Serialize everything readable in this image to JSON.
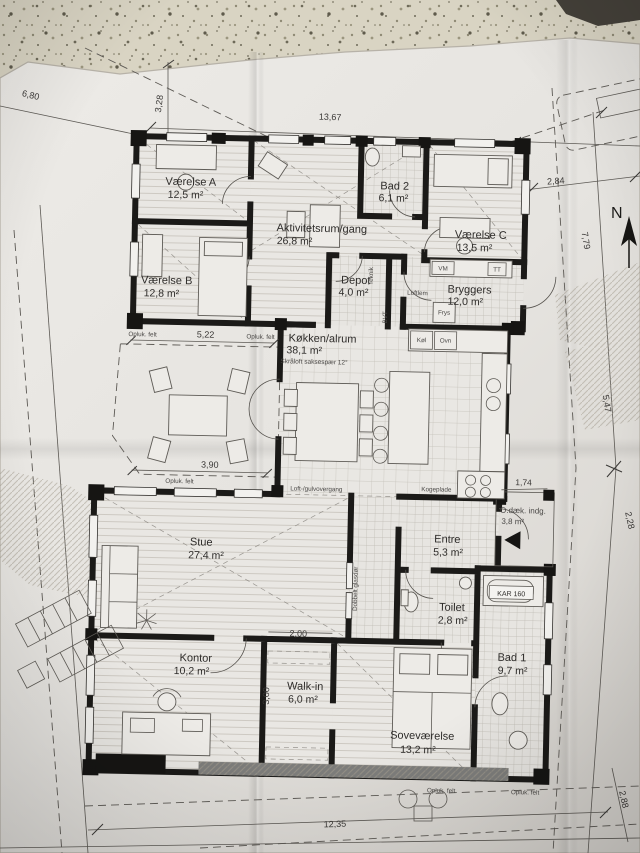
{
  "compass": {
    "north_label": "N"
  },
  "rooms": [
    {
      "name": "Værelse A",
      "area": "12,5 m²"
    },
    {
      "name": "Værelse B",
      "area": "12,8 m²"
    },
    {
      "name": "Aktivitetsrum/gang",
      "area": "26,8 m²"
    },
    {
      "name": "Bad 2",
      "area": "6,1 m²"
    },
    {
      "name": "Værelse C",
      "area": "13,5 m²"
    },
    {
      "name": "Depot",
      "area": "4,0 m²"
    },
    {
      "name": "Bryggers",
      "area": "12,0 m²"
    },
    {
      "name": "Køkken/alrum",
      "area": "38,1 m²",
      "note": "Skråloft saksespær 12°"
    },
    {
      "name": "Stue",
      "area": "27,4 m²"
    },
    {
      "name": "Entre",
      "area": "5,3 m²"
    },
    {
      "name": "Toilet",
      "area": "2,8 m²"
    },
    {
      "name": "Kontor",
      "area": "10,2 m²"
    },
    {
      "name": "Walk-in",
      "area": "6,0 m²"
    },
    {
      "name": "Soveværelse",
      "area": "13,2 m²"
    },
    {
      "name": "Bad 1",
      "area": "9,7 m²"
    },
    {
      "name": "O.dæk. indg.",
      "area": "3,8 m²"
    }
  ],
  "dimensions": {
    "top_left_diagonal": "6,80",
    "top_vertical": "3,28",
    "top_width": "13,67",
    "right_upper": "2,84",
    "right_boundary_upper": "7,79",
    "right_boundary_mid": "5,47",
    "right_boundary_lower": "2,28",
    "deck_width": "1,74",
    "terrace_top": "5,22",
    "terrace_bottom": "3,90",
    "walkin_width": "2,00",
    "walkin_depth": "3,00",
    "bottom_width": "12,35",
    "bottom_right": "2,88"
  },
  "annotations": {
    "opluk_felt": "Opluk. felt",
    "loft_gulvovergang": "Loft-/gulvovergang",
    "kogeplade": "Kogeplade",
    "dobbelt_glasdor": "Dobbelt glasdør",
    "kar": "KAR 160",
    "loftlem": "Loftlem",
    "teknik": "Teknik",
    "bvt": "BVT",
    "vm": "VM",
    "tt": "TT",
    "frys": "Frys",
    "kol": "Køl",
    "ovn": "Ovn"
  }
}
